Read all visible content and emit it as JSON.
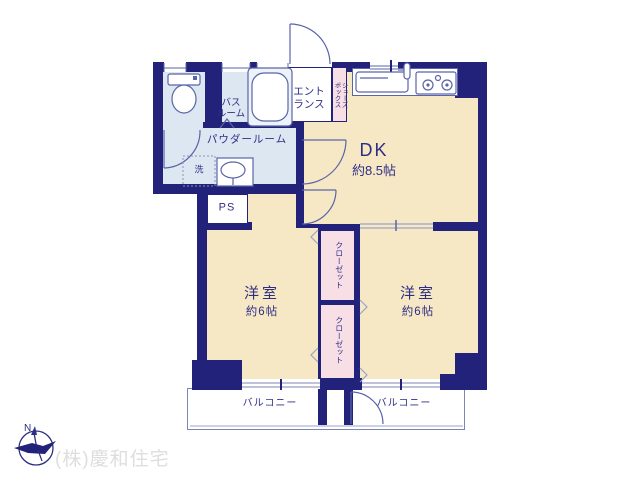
{
  "plan": {
    "dk": {
      "label": "DK",
      "size": "約8.5帖"
    },
    "bedroom_left": {
      "label": "洋室",
      "size": "約6帖"
    },
    "bedroom_right": {
      "label": "洋室",
      "size": "約6帖"
    },
    "bathroom": {
      "line1": "バス",
      "line2": "ルーム"
    },
    "powder_room": {
      "label": "パウダールーム"
    },
    "washer": {
      "label": "洗"
    },
    "entrance": {
      "line1": "エント",
      "line2": "ランス"
    },
    "shoe_box": {
      "line1": "シューズ",
      "line2": "ボックス"
    },
    "closet_front": {
      "label": "クローゼット"
    },
    "closet_back": {
      "label": "クローゼット"
    },
    "ps": {
      "label": "PS"
    },
    "balcony_left": {
      "label": "バルコニー"
    },
    "balcony_right": {
      "label": "バルコニー"
    }
  },
  "compass": {
    "label": "N"
  },
  "watermark": {
    "label": "(株)慶和住宅"
  },
  "colors": {
    "wall": "#22227a",
    "room_cream": "#f6e8c5",
    "wet_area_blue": "#dce7f2",
    "closet_pink": "#f8dee5",
    "text_navy": "#2e2e85",
    "fixture_line": "#5a64a8",
    "balcony_line": "#7c85b5",
    "watermark_gray": "#dedede"
  }
}
